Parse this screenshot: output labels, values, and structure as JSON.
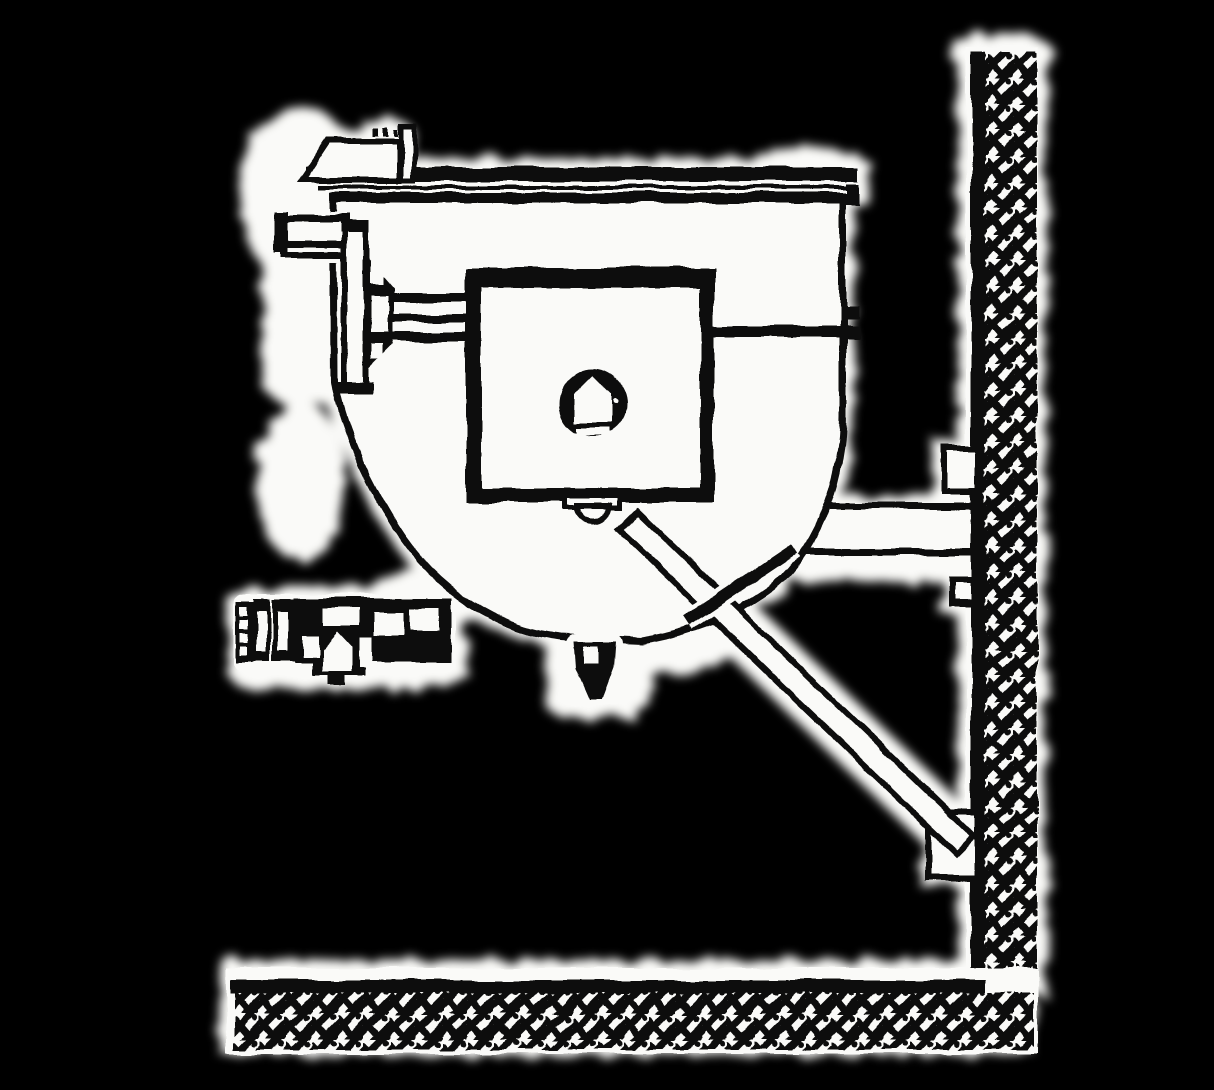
{
  "figure": {
    "kind": "scanned technical line drawing",
    "subject": "Side elevation of a wall-mounted tilting kettle on a support bracket",
    "visible_text": "none",
    "style": "black ink linework with white paper halos on a black background"
  },
  "colors": {
    "background": "#000000",
    "ink": "#0d0d0d",
    "paper": "#fafaf8"
  },
  "components": {
    "wall": {
      "label": "hatched wall section at right"
    },
    "floor": {
      "label": "hatched floor section at bottom"
    },
    "kettle": {
      "label": "kettle bowl body"
    },
    "rim": {
      "label": "kettle rim band"
    },
    "lip": {
      "label": "pouring lip at top left"
    },
    "trunnion": {
      "label": "trunnion pivot plate and inlet pipe"
    },
    "shaft": {
      "label": "tilt shaft to console"
    },
    "console": {
      "label": "control console box"
    },
    "knob": {
      "label": "console knob with keyed hub"
    },
    "tie": {
      "label": "tie rod from console to kettle shell"
    },
    "shelf": {
      "label": "wall-mounted support shelf"
    },
    "cradle": {
      "label": "pivot cradle under console"
    },
    "brace": {
      "label": "diagonal support brace to wall"
    },
    "strut": {
      "label": "short cross strut"
    },
    "bracketTop": {
      "label": "upper wall mounting lug"
    },
    "bracketMid": {
      "label": "middle wall mounting lug"
    },
    "bracketLow": {
      "label": "lower wall brace anchor"
    },
    "valve": {
      "label": "draw-off valve with hose fitting"
    },
    "drain": {
      "label": "bottom drain fitting"
    }
  }
}
